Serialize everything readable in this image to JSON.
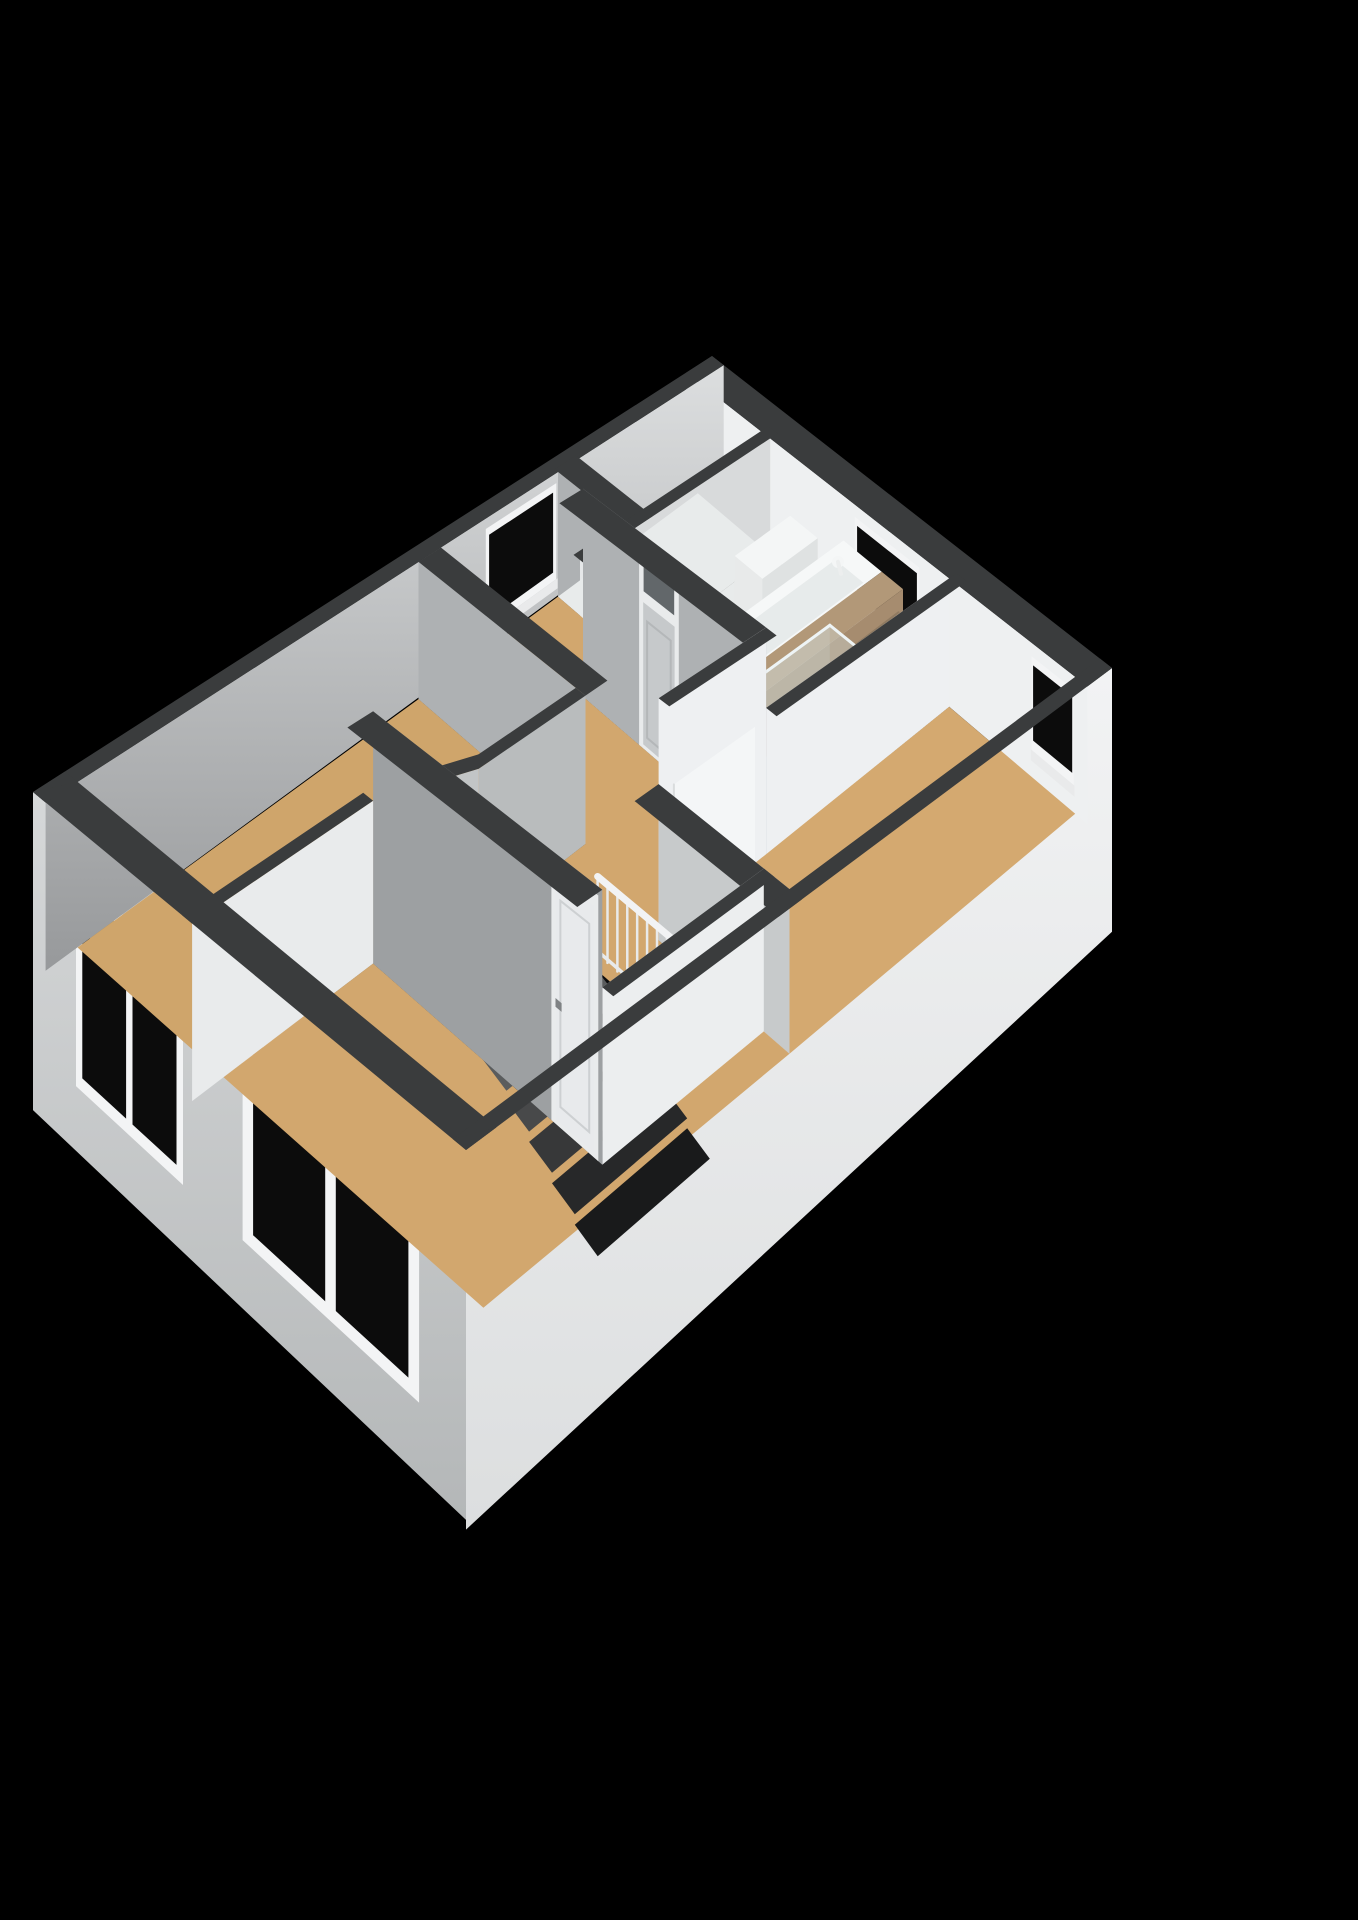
{
  "scene": {
    "kind": "3d-floorplan-cutaway-render",
    "background": "#000000",
    "view": "axonometric-from-south",
    "storey": "upper-floor"
  },
  "rooms": [
    {
      "name": "bathroom",
      "floor_finish": "light-tile"
    },
    {
      "name": "bedroom-right",
      "floor_finish": "tan"
    },
    {
      "name": "bedroom-left",
      "floor_finish": "tan"
    },
    {
      "name": "bedroom-front",
      "floor_finish": "tan"
    },
    {
      "name": "landing",
      "floor_finish": "tan"
    }
  ],
  "fixtures": [
    "bathtub",
    "bath-faucet",
    "wood-vanity-cabinet",
    "shower-glass-screen",
    "toilet",
    "staircase",
    "stair-balustrade",
    "stair-top-step"
  ],
  "openings": {
    "windows": [
      "bathroom-window-ne",
      "bedroom-right-window-ne",
      "landing-window-nw",
      "bedroom-left-window-sw",
      "bedroom-front-window-sw"
    ],
    "doors": [
      "bathroom-door-with-transom",
      "bedroom-right-door-open",
      "bedroom-front-door",
      "door-handles"
    ]
  },
  "colors": {
    "bg": "#000000",
    "cap": "#3a3c3d",
    "capDark": "#333536",
    "seFaceTop": "#f2f3f4",
    "seFaceBot": "#dfe1e2",
    "swFaceTop": "#d6d8d9",
    "swFaceBot": "#b9bcbd",
    "neInner": "#eef0f1",
    "nwInnerTop": "#dcdedf",
    "nwInnerBot": "#97999b",
    "wallWhite": "#eef0f2",
    "wallLight": "#d8dadb",
    "wallMid": "#c2c5c6",
    "wallGray": "#aeb1b3",
    "wallGrayDk": "#9da0a2",
    "endFace": "#e6e8e9",
    "floorTan": "#d2a76e",
    "floorTanL": "#cfa56b",
    "floorTanR": "#d4a970",
    "floorTanDim": "#b8945e",
    "bathFloor": "#e8ebeb",
    "showerFloor": "#c9dde0",
    "showerEdge": "#aecdd2",
    "glass": "#d6e8ea",
    "glassEdge": "#eef4f5",
    "windowGlass": "#0c0c0c",
    "frame": "#f3f4f5",
    "sill": "#e9eaeb",
    "tubRim": "#f6f8f8",
    "tubInner": "#e7ebeb",
    "tubSide": "#edf0f0",
    "wood": "#b29878",
    "woodFront": "#a68c6f",
    "woodSide": "#99815f",
    "woodLine": "#8f7a61",
    "toiletTop": "#f4f6f6",
    "toiletFront": "#e8eaea",
    "toiletSide": "#dfe2e2",
    "doorGray": "#c6c9cb",
    "doorLight": "#e9ebec",
    "doorLeaf": "#f4f6f7",
    "transom": "#62676a",
    "handle": "#7f8284",
    "void": "#0b0b0c",
    "stair0": "#5a5c5d",
    "stair1": "#48494a",
    "stair2": "#373839",
    "stair3": "#272829",
    "stair4": "#191a1b",
    "balRail": "#f2f3f4",
    "balPost": "#e8eaeb",
    "stepTop": "#f0f1f2",
    "stepFront": "#d8dad9"
  }
}
